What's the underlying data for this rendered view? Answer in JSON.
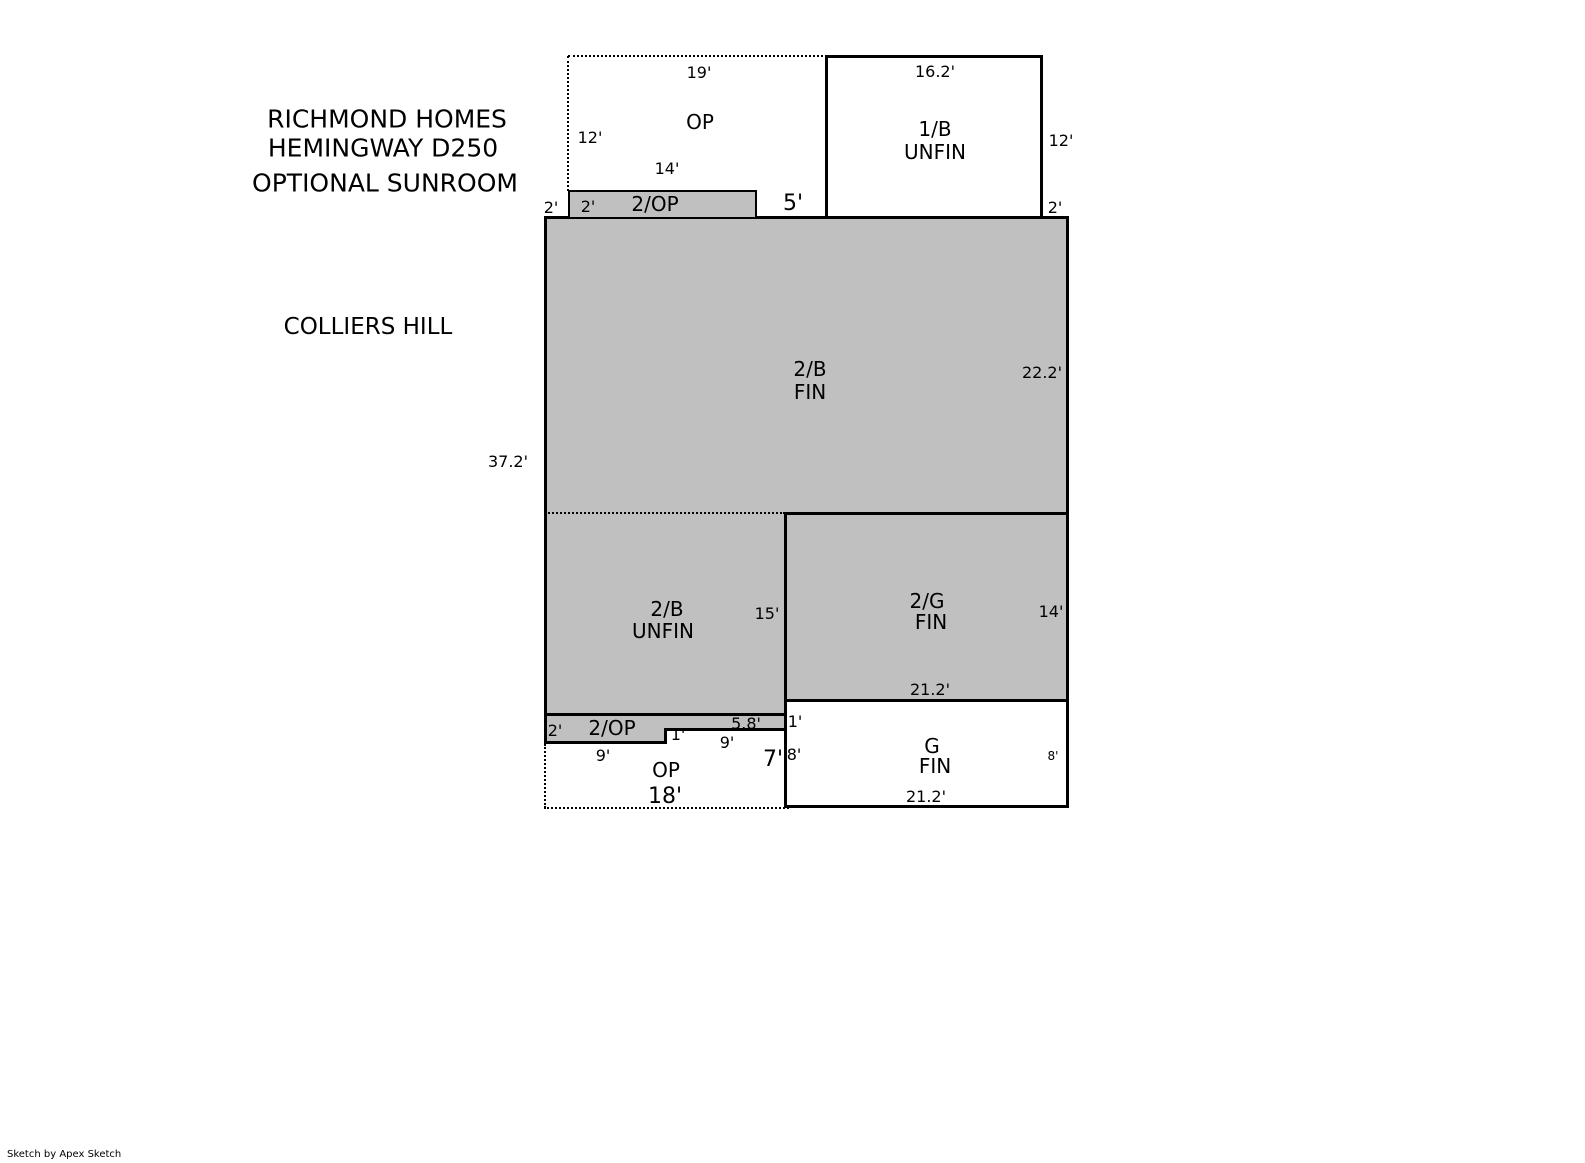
{
  "title": {
    "line1": "RICHMOND HOMES",
    "line2": "HEMINGWAY D250",
    "line3": "OPTIONAL SUNROOM"
  },
  "subdivision": "COLLIERS HILL",
  "credit": "Sketch by Apex Sketch",
  "colors": {
    "area_fill": "#c0c0c0",
    "line": "#000000",
    "background": "#ffffff"
  },
  "rooms": {
    "op_top": "OP",
    "two_op_top": "2/OP",
    "one_b_line1": "1/B",
    "one_b_line2": "UNFIN",
    "two_b_fin_line1": "2/B",
    "two_b_fin_line2": "FIN",
    "two_b_unfin_line1": "2/B",
    "two_b_unfin_line2": "UNFIN",
    "two_g_line1": "2/G",
    "two_g_line2": "FIN",
    "g_line1": "G",
    "g_line2": "FIN",
    "two_op_bottom": "2/OP",
    "op_bottom": "OP"
  },
  "dims": {
    "op_width": "19'",
    "op_left": "12'",
    "two_op_width": "14'",
    "left_offset": "2'",
    "two_op_inset": "2'",
    "gap": "5'",
    "one_b_width": "16.2'",
    "one_b_right": "12'",
    "one_b_offset": "2'",
    "two_b_right": "22.2'",
    "left_total": "37.2'",
    "two_b_unfin_right": "15'",
    "two_g_right": "14'",
    "two_g_width": "21.2'",
    "g_step": "1'",
    "g_left": "8'",
    "g_right": "8'",
    "g_width": "21.2'",
    "strip_left_h": "2'",
    "strip_step": "1'",
    "strip_sub": "5.8'",
    "strip_seg_right": "9'",
    "strip_seg_left": "9'",
    "op_right": "7'",
    "op_bottom_width": "18'"
  }
}
